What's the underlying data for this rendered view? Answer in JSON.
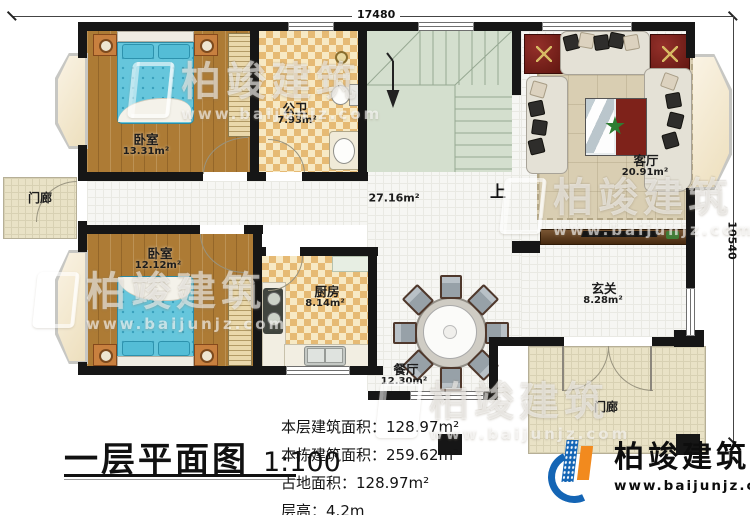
{
  "title_block": {
    "title": "一层平面图",
    "scale": "1:100"
  },
  "dimensions": {
    "top": "17480",
    "right": "10540"
  },
  "rooms": {
    "bedroom1": {
      "name": "卧室",
      "area": "13.31m²"
    },
    "bathroom": {
      "name": "公卫",
      "area": "7.93m²"
    },
    "hall": {
      "area": "27.16m²"
    },
    "stairs": {
      "up_label": "上"
    },
    "living_room": {
      "name": "客厅",
      "area": "20.91m²"
    },
    "porch_left": {
      "name": "门廊"
    },
    "bedroom2": {
      "name": "卧室",
      "area": "12.12m²"
    },
    "kitchen": {
      "name": "厨房",
      "area": "8.14m²"
    },
    "dining_room": {
      "name": "餐厅",
      "area": "12.30m²"
    },
    "foyer": {
      "name": "玄关",
      "area": "8.28m²"
    },
    "porch_right": {
      "name": "门廊"
    }
  },
  "stats": [
    {
      "label": "本层建筑面积：",
      "value": "128.97m²"
    },
    {
      "label": "本栋建筑面积：",
      "value": "259.62m²"
    },
    {
      "label": "占地面积：",
      "value": "128.97m²"
    },
    {
      "label": "层高：",
      "value": "4.2m"
    }
  ],
  "brand": {
    "name": "柏竣建筑",
    "url": "www.baijunjz.com"
  },
  "watermark": {
    "name": "柏竣建筑",
    "url": "www.baijunjz.com"
  },
  "colors": {
    "wall": "#161616",
    "wood_floor": "#ad7b35",
    "tile_checker": "#e6ba74",
    "stair": "#d4dfce",
    "bed_blue": "#5fc3da",
    "accent_red": "#6e1b14",
    "brand_blue": "#1465b5",
    "brand_orange": "#f28a1e"
  }
}
